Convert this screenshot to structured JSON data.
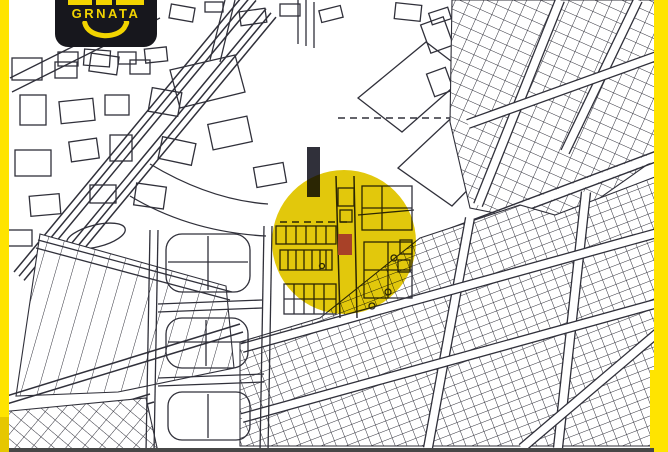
{
  "logo": {
    "brand": "GRNATA"
  },
  "colors": {
    "background": "#ffffff",
    "map_line": "#30303a",
    "stripe_yellow": "#ffe400",
    "stripe_shade": "#e6c700",
    "highlight_yellow": "#e2c80c",
    "marker_red": "#a84128",
    "logo_bg": "#17171d",
    "logo_yellow": "#f2d400",
    "bottom_bar": "#474747"
  },
  "map": {
    "highlight_circle": {
      "center_x": 344,
      "center_y": 242,
      "radius": 72
    },
    "marker": {
      "x": 338,
      "y": 234,
      "width": 14,
      "height": 21
    }
  }
}
